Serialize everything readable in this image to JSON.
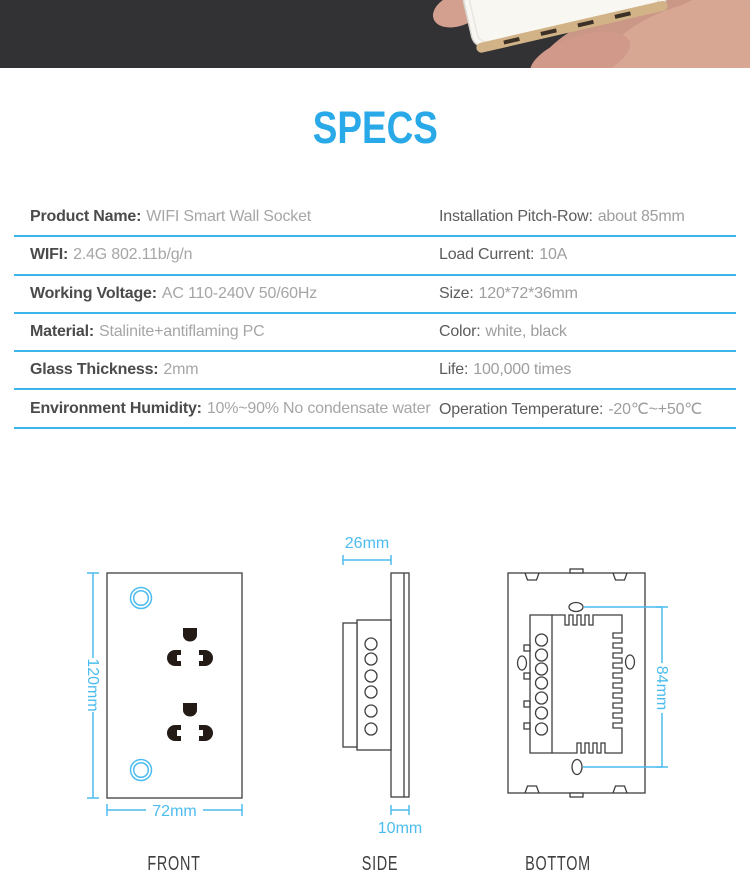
{
  "title": "SPECS",
  "colors": {
    "accent_blue": "#29a9e8",
    "table_line_blue": "#3cb4ec",
    "dimension_blue": "#4cbcee",
    "header_band": "#323234",
    "drawing_outline": "#3f3f3f"
  },
  "header": {
    "photo": "hand-holding-white-smart-wall-socket"
  },
  "table": {
    "rows": [
      {
        "left_label": "Product Name:",
        "left_value": "WIFI Smart Wall Socket",
        "right_label": "Installation Pitch-Row:",
        "right_value": "about 85mm"
      },
      {
        "left_label": "WIFI:",
        "left_value": "2.4G 802.11b/g/n",
        "right_label": "Load Current:",
        "right_value": "10A"
      },
      {
        "left_label": "Working Voltage:",
        "left_value": "AC 110-240V 50/60Hz",
        "right_label": "Size:",
        "right_value": "120*72*36mm"
      },
      {
        "left_label": "Material:",
        "left_value": "Stalinite+antiflaming PC",
        "right_label": "Color:",
        "right_value": "white, black"
      },
      {
        "left_label": "Glass Thickness:",
        "left_value": "2mm",
        "right_label": "Life:",
        "right_value": "100,000 times"
      },
      {
        "left_label": "Environment Humidity:",
        "left_value": "10%~90% No condensate water",
        "right_label": "Operation Temperature:",
        "right_value": "-20℃~+50℃"
      }
    ]
  },
  "diagrams": {
    "front": {
      "label": "FRONT",
      "height_dim": "120mm",
      "width_dim": "72mm"
    },
    "side": {
      "label": "SIDE",
      "depth_dim": "26mm",
      "plate_dim": "10mm"
    },
    "bottom": {
      "label": "BOTTOM",
      "height_dim": "84mm"
    }
  }
}
